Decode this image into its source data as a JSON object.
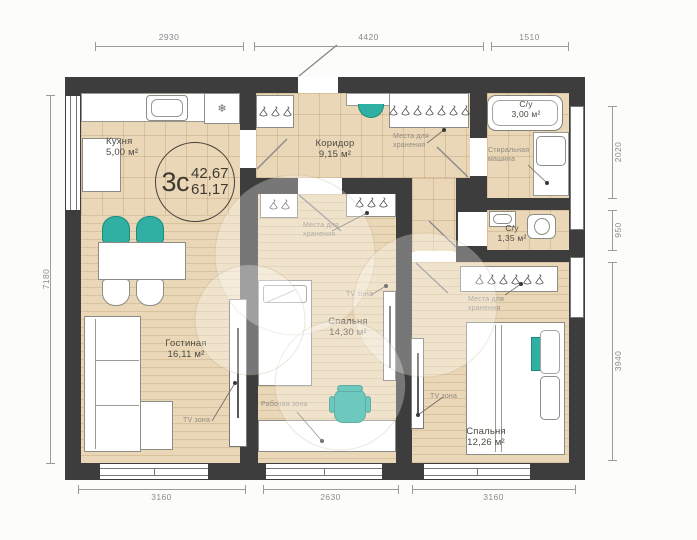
{
  "plan": {
    "badge": {
      "code": "3с",
      "area_living": "42,67",
      "area_total": "61,17"
    },
    "rooms": [
      {
        "name": "Кухня",
        "area": "5,00 м²"
      },
      {
        "name": "Коридор",
        "area": "9,15 м²"
      },
      {
        "name": "С/у",
        "area": "3,00 м²"
      },
      {
        "name": "С/у",
        "area": "1,35 м²"
      },
      {
        "name": "Гостиная",
        "area": "16,11 м²"
      },
      {
        "name": "Спальня",
        "area": "14,30 м²"
      },
      {
        "name": "Спальня",
        "area": "12,26 м²"
      }
    ],
    "zones": {
      "tv": "TV зона",
      "work": "Рабочая зона",
      "storage_line1": "Места для",
      "storage_line2": "хранения",
      "washer_line1": "Стиральная",
      "washer_line2": "машина"
    },
    "dims": {
      "top": [
        "2930",
        "4420",
        "1510"
      ],
      "bottom": [
        "3160",
        "2630",
        "3160"
      ],
      "left": [
        "7180"
      ],
      "right": [
        "2020",
        "950",
        "3940"
      ]
    },
    "icons": {
      "fridge": "❄"
    },
    "colors": {
      "wall": "#3d3d3d",
      "floor": "#ead7b7",
      "accent": "#2fb0a2"
    }
  }
}
